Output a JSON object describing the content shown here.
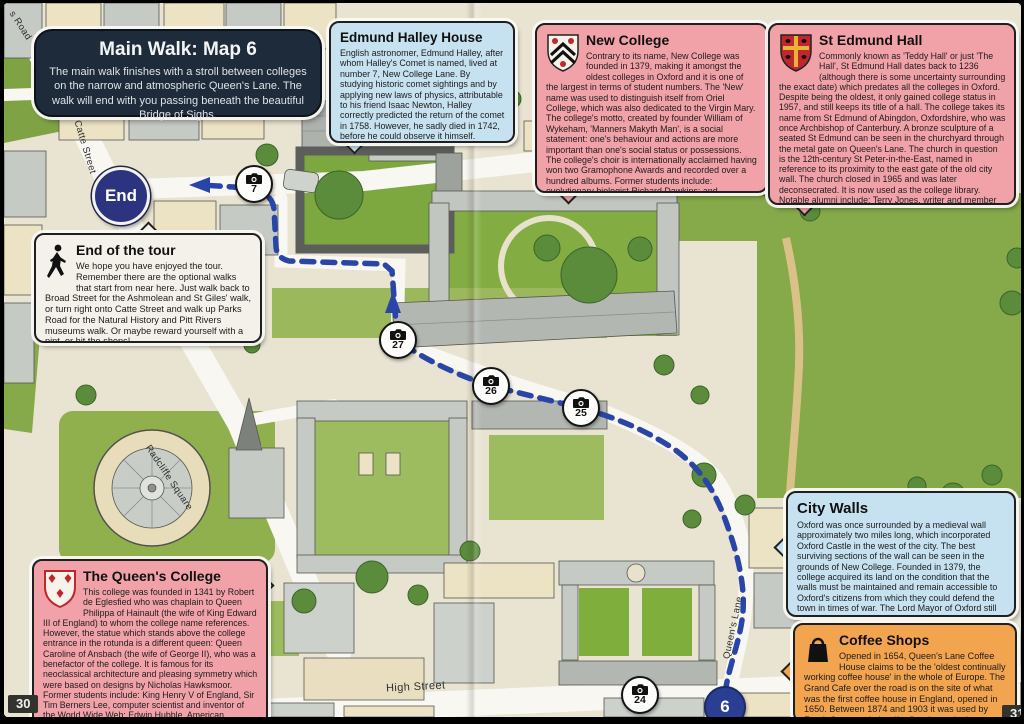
{
  "page": {
    "left_number": "30",
    "right_number": "31"
  },
  "header": {
    "title": "Main Walk: Map 6",
    "description": "The main walk finishes with a stroll between colleges on the narrow and atmospheric Queen's Lane. The walk will end with you passing beneath the beautiful Bridge of Sighs."
  },
  "callouts": {
    "edmund_halley": {
      "title": "Edmund Halley House",
      "body": "English astronomer, Edmund Halley, after whom Halley's Comet is named, lived at number 7, New College Lane. By studying historic comet sightings and by applying new laws of physics, attributable to his friend Isaac Newton, Halley correctly predicted the return of the comet in 1758. However, he sadly died in 1742, before he could observe it himself."
    },
    "new_college": {
      "title": "New College",
      "body": "Contrary to its name, New College was founded in 1379, making it amongst the oldest colleges in Oxford and it is one of the largest in terms of student numbers. The 'New' name was used to distinguish itself from Oriel College, which was also dedicated to the Virgin Mary. The college's motto, created by founder William of Wykeham, 'Manners Makyth Man', is a social statement: one's behaviour and actions are more important than one's social status or possessions. The college's choir is internationally acclaimed having won two Gramophone Awards and recorded over a hundred albums. Former students include: evolutionary biologist Richard Dawkins; and Hollywood stars Hugh Grant and Kate Beckinsale."
    },
    "st_edmund_hall": {
      "title": "St Edmund Hall",
      "body": "Commonly known as 'Teddy Hall' or just 'The Hall', St Edmund Hall dates back to 1236 (although there is some uncertainty surrounding the exact date) which predates all the colleges in Oxford. Despite being the oldest, it only gained college status in 1957, and still keeps its title of a hall. The college takes its name from St Edmund of Abingdon, Oxfordshire, who was once Archbishop of Canterbury. A bronze sculpture of a seated St Edmund can be seen in the churchyard through the metal gate on Queen's Lane. The church in question is the 12th-century St Peter-in-the-East, named in reference to its proximity to the east gate of the old city wall. The church closed in 1965 and was later deconsecrated. It is now used as the college library. Notable alumni include: Terry Jones, writer and member of Monty Python comedy group."
    },
    "end_of_tour": {
      "title": "End of the tour",
      "body": "We hope you have enjoyed the tour. Remember there are the optional walks that start from near here. Just walk back to Broad Street for the Ashmolean and St Giles' walk, or turn right onto Catte Street and walk up Parks Road for the Natural History and Pitt Rivers museums walk. Or maybe reward yourself with a pint, or hit the shops!"
    },
    "queens_college": {
      "title": "The Queen's College",
      "body": "This college was founded in 1341 by Robert de Eglesfied who was chaplain to Queen Philippa of Hainault (the wife of King Edward III of England) to whom the college name references. However, the statue which stands above the college entrance in the rotunda is a different queen: Queen Caroline of Ansbach (the wife of George II), who was a benefactor of the college. It is famous for its neoclassical architecture and pleasing symmetry which were based on designs by Nicholas Hawksmoor. Former students include: King Henry V of England, Sir Tim Berners Lee, computer scientist and inventor of the World Wide Web; Edwin Hubble, American astronomer and after whom the Hubble Space Telescope was named; and actor Rowan Atkinson, famous for his characters Blackadder and Mr Bean."
    },
    "city_walls": {
      "title": "City Walls",
      "body": "Oxford was once surrounded by a medieval wall approximately two miles long, which incorporated Oxford Castle in the west of the city. The best surviving sections of the wall can be seen in the grounds of New College. Founded in 1379, the college acquired its land on the condition that the walls must be maintained and remain accessible to Oxford's citizens from which they could defend the town in times of war. The Lord Mayor of Oxford still inspects the wall every three years in a tradition that has been ongoing for nearly 640 years."
    },
    "coffee_shops": {
      "title": "Coffee Shops",
      "body": "Opened in 1654, Queen's Lane Coffee House claims to be the 'oldest continually working coffee house' in the whole of Europe. The Grand Cafe over the road is on the site of what was the first coffee house in England, opened in 1650. Between 1874 and 1903 it was used by Frank Cooper who's wife, Sarah, made the famous Oxford Marmalade from here."
    }
  },
  "map": {
    "end_label": "End",
    "continuation": "6",
    "cameras": [
      {
        "label": "7"
      },
      {
        "label": "27"
      },
      {
        "label": "26"
      },
      {
        "label": "25"
      },
      {
        "label": "24"
      }
    ],
    "streets": {
      "parks_road": "s Road",
      "catte": "Catte Street",
      "radcliffe": "Radcliffe Square",
      "queens_lane": "Queen's Lane",
      "high": "High Street"
    }
  },
  "icons": {
    "camera": "camera-icon on numbered photo-spot markers",
    "walking_person": "pedestrian-icon on End of the tour box",
    "coffee_bag": "coffee-bag-icon on Coffee Shops box",
    "crest_new_college": "white shield, black chevrons, red roses",
    "crest_st_edmund": "red shield, gold cross, black birds",
    "crest_queens": "white shield, red eagles"
  },
  "colors": {
    "header_navy": "#1d2b3a",
    "callout_pink": "#f1a2a9",
    "callout_blue": "#c6e1f0",
    "callout_orange": "#f3a44e",
    "callout_white": "#f3f1ea",
    "route_blue": "#2945a8",
    "end_circle": "#2c3480",
    "continuation_circle": "#2a3e94",
    "grass_green": "#8fb04c",
    "page_cream": "#e9e4d2"
  }
}
